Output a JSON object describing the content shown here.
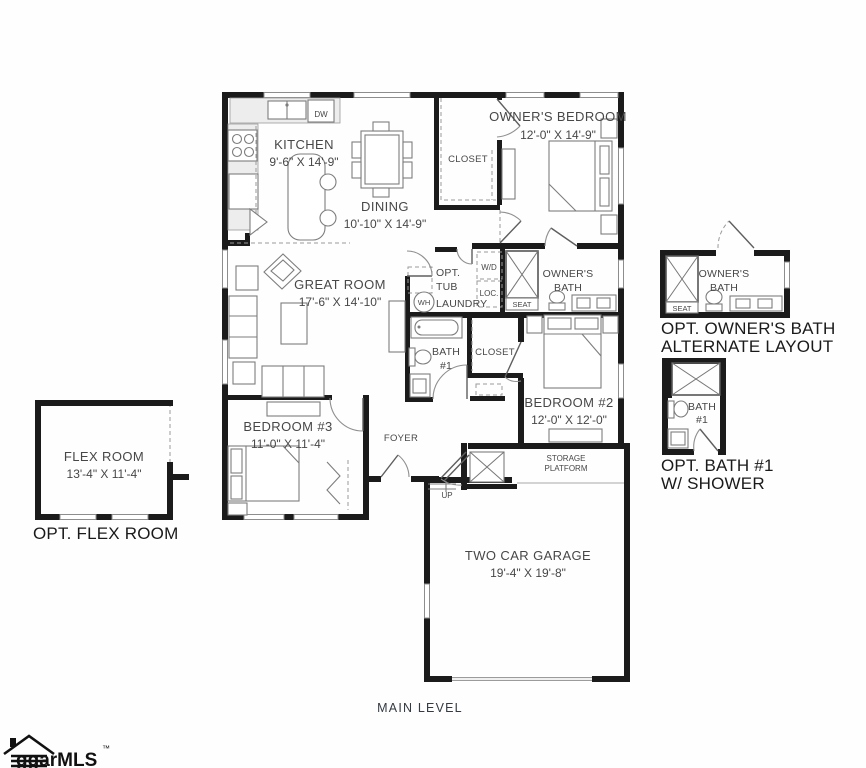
{
  "colors": {
    "wall": "#1b1b1b",
    "furniture_line": "#7d7d7d",
    "dashed_line": "#9a9a9a",
    "label_text": "#474747",
    "caption_text": "#1a1a1a",
    "level_text": "#333a42"
  },
  "rooms": {
    "kitchen": {
      "name": "KITCHEN",
      "dims": "9'-6\" X 14'-9\"",
      "dishwasher": "DW"
    },
    "dining": {
      "name": "DINING",
      "dims": "10'-10\" X 14'-9\""
    },
    "owners_bedroom": {
      "name": "OWNER'S BEDROOM",
      "dims": "12'-0\" X 14'-9\""
    },
    "owners_closet": {
      "name": "CLOSET"
    },
    "great_room": {
      "name": "GREAT ROOM",
      "dims": "17'-6\" X 14'-10\""
    },
    "laundry": {
      "name": "LAUNDRY",
      "opt_tub_line1": "OPT.",
      "opt_tub_line2": "TUB",
      "water_heater": "WH",
      "washer_dryer": "W/D",
      "location": "LOC."
    },
    "owners_bath": {
      "line1": "OWNER'S",
      "line2": "BATH",
      "seat": "SEAT"
    },
    "bath1": {
      "line1": "BATH",
      "line2": "#1"
    },
    "bedroom2_closet": {
      "name": "CLOSET"
    },
    "bedroom2": {
      "name": "BEDROOM #2",
      "dims": "12'-0\" X 12'-0\""
    },
    "bedroom3": {
      "name": "BEDROOM #3",
      "dims": "11'-0\" X 11'-4\""
    },
    "foyer": {
      "name": "FOYER",
      "up": "UP"
    },
    "storage_platform": {
      "line1": "STORAGE",
      "line2": "PLATFORM"
    },
    "garage": {
      "name": "TWO CAR GARAGE",
      "dims": "19'-4\" X 19'-8\""
    }
  },
  "options": {
    "flex_room": {
      "name": "FLEX ROOM",
      "dims": "13'-4\" X 11'-4\"",
      "caption": "OPT. FLEX ROOM"
    },
    "owners_bath_alt": {
      "room_line1": "OWNER'S",
      "room_line2": "BATH",
      "seat": "SEAT",
      "caption_line1": "OPT. OWNER'S BATH",
      "caption_line2": "ALTERNATE LAYOUT"
    },
    "bath1_shower": {
      "room_line1": "BATH",
      "room_line2": "#1",
      "caption_line1": "OPT. BATH #1",
      "caption_line2": "W/ SHOWER"
    }
  },
  "footer": {
    "level_label": "MAIN LEVEL",
    "logo_text": "ggarMLS",
    "logo_tm": "™"
  }
}
